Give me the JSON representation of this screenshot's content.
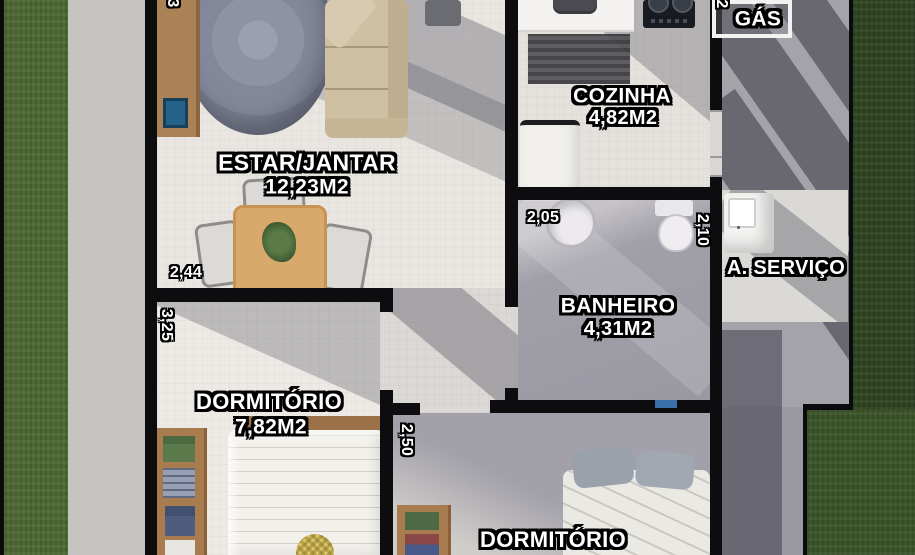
{
  "labels": {
    "estar": {
      "name": "ESTAR/JANTAR",
      "area": "12,23M2"
    },
    "cozinha": {
      "name": "COZINHA",
      "area": "4,82M2"
    },
    "banheiro": {
      "name": "BANHEIRO",
      "area": "4,31M2"
    },
    "dorm1": {
      "name": "DORMITÓRIO",
      "area": "7,82M2"
    },
    "dorm2": {
      "name": "DORMITÓRIO"
    },
    "servico": {
      "name": "A. SERVIÇO"
    },
    "gas": {
      "name": "GÁS"
    }
  },
  "dims": {
    "living_width": "2,44",
    "dorm1_depth": "3,25",
    "bath_width": "2,05",
    "bath_depth": "2,10",
    "dorm2_depth": "2,50",
    "partial_top_left": "3",
    "partial_top_right": "2"
  },
  "colors": {
    "wall": "#0d0d10",
    "grass_left": "#4d6833",
    "grass_right": "#2f4522",
    "walkway_light": "#c6c4c1",
    "walkway_shaded": "#a4a3a9",
    "floor_light": "#e9e6e2",
    "floor_shaded": "#a19fa8",
    "sofa": "#cfc0a3",
    "wood_furniture": "#a87c4f",
    "table_wood": "#d8a96a",
    "label_text": "#ffffff",
    "label_outline": "#000000"
  }
}
